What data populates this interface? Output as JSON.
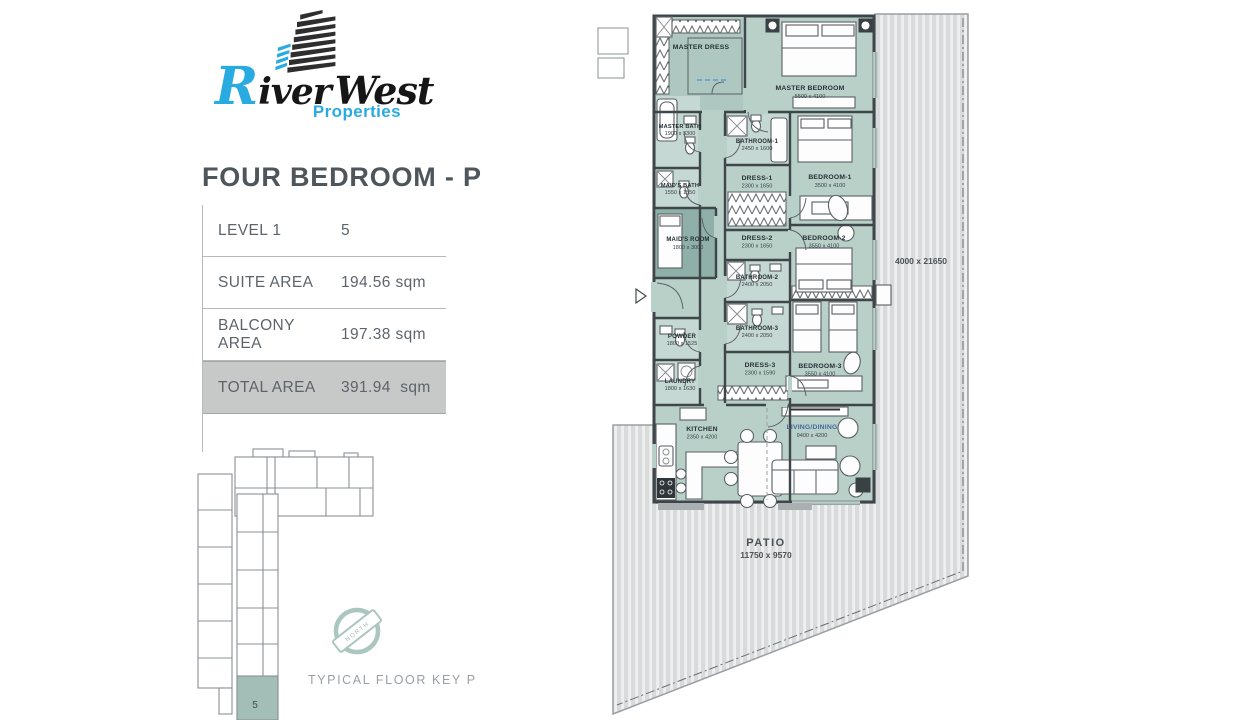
{
  "brand": {
    "initial": "R",
    "word1": "iver",
    "word2": "West",
    "tagline": "Properties"
  },
  "page": {
    "title": "FOUR BEDROOM - P"
  },
  "info_table": {
    "rows": [
      {
        "label": "LEVEL 1",
        "value": "5"
      },
      {
        "label": "SUITE AREA",
        "value": "194.56 sqm"
      },
      {
        "label": "BALCONY AREA",
        "value": "197.38 sqm"
      },
      {
        "label": "TOTAL AREA",
        "value": "391.94  sqm"
      }
    ]
  },
  "key_plan": {
    "caption": "TYPICAL FLOOR KEY PLAN",
    "unit_number": "5",
    "compass_label": "NORTH"
  },
  "plan": {
    "rooms": [
      {
        "name": "MASTER DRESS",
        "dims": ""
      },
      {
        "name": "MASTER BEDROOM",
        "dims": "5500 x 4100"
      },
      {
        "name": "MASTER BATH",
        "dims": "1900 x 3300"
      },
      {
        "name": "BATHROOM-1",
        "dims": "2450 x 1600"
      },
      {
        "name": "MAID'S BATH",
        "dims": "1550 x 1550"
      },
      {
        "name": "DRESS-1",
        "dims": "2300 x 1650"
      },
      {
        "name": "BEDROOM-1",
        "dims": "3500 x 4100"
      },
      {
        "name": "MAID'S ROOM",
        "dims": "1800 x 3000"
      },
      {
        "name": "DRESS-2",
        "dims": "2300 x 1650"
      },
      {
        "name": "BEDROOM-2",
        "dims": "3550 x 4100"
      },
      {
        "name": "BATHROOM-2",
        "dims": "2400 x 2050"
      },
      {
        "name": "BATHROOM-3",
        "dims": "2400 x 2050"
      },
      {
        "name": "DRESS-3",
        "dims": "2300 x 1590"
      },
      {
        "name": "BEDROOM-3",
        "dims": "3550 x 4100"
      },
      {
        "name": "POWDER",
        "dims": "1800 x 1525"
      },
      {
        "name": "LAUNDRY",
        "dims": "1800 x 1630"
      },
      {
        "name": "KITCHEN",
        "dims": "2350 x 4200"
      },
      {
        "name": "LIVING/DINING",
        "dims": "9400 x 4200"
      }
    ],
    "patio": {
      "name": "PATIO",
      "dims": "11750 x 9570"
    },
    "balcony_dims": "4000 x 21650"
  },
  "colors": {
    "accent_blue": "#29abe2",
    "room_teal": "#b9d0c9",
    "room_teal_dark": "#8fb0a8",
    "highlight_gray": "#c7c8c8"
  }
}
